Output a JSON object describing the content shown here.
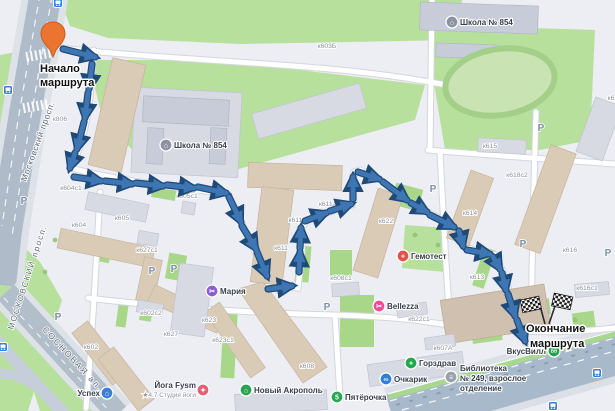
{
  "route": {
    "color": "#3E76B4",
    "outline_color": "#1F4A78",
    "pin_color": "#EA7430",
    "start_label": {
      "line1": "Начало",
      "line2": "маршрута"
    },
    "end_label": {
      "line1": "Окончание",
      "line2": "маршрута"
    },
    "segments": [
      [
        63,
        49,
        95,
        57
      ],
      [
        92,
        64,
        89,
        89
      ],
      [
        88,
        93,
        85,
        118
      ],
      [
        84,
        122,
        77,
        149
      ],
      [
        75,
        153,
        70,
        168
      ],
      [
        74,
        177,
        101,
        181
      ],
      [
        105,
        181,
        132,
        184
      ],
      [
        136,
        183,
        163,
        186
      ],
      [
        167,
        185,
        194,
        188
      ],
      [
        198,
        187,
        226,
        193
      ],
      [
        229,
        197,
        241,
        222
      ],
      [
        242,
        226,
        256,
        249
      ],
      [
        257,
        252,
        267,
        276
      ],
      [
        268,
        289,
        292,
        286
      ],
      [
        299,
        272,
        300,
        252
      ],
      [
        300,
        248,
        301,
        228
      ],
      [
        305,
        221,
        326,
        213
      ],
      [
        330,
        211,
        351,
        204
      ],
      [
        353,
        199,
        353,
        177
      ],
      [
        358,
        172,
        379,
        179
      ],
      [
        383,
        182,
        407,
        200
      ],
      [
        411,
        203,
        427,
        212
      ],
      [
        430,
        215,
        454,
        227
      ],
      [
        459,
        231,
        463,
        246
      ],
      [
        467,
        250,
        490,
        254
      ],
      [
        493,
        257,
        500,
        269
      ],
      [
        502,
        273,
        506,
        290
      ],
      [
        508,
        294,
        515,
        316
      ],
      [
        517,
        320,
        525,
        341
      ]
    ]
  },
  "streets": [
    {
      "name": "Московский просп.",
      "x": 26,
      "y": 182,
      "rotate": -70,
      "size": 8.5,
      "spacing": 0.6
    },
    {
      "name": "МОСКОВСКИЙ просп.",
      "x": 13,
      "y": 330,
      "rotate": -72,
      "size": 8,
      "spacing": 1.6
    },
    {
      "name": "СОСНОВАЯ ал.",
      "x": 42,
      "y": 330,
      "rotate": 47,
      "size": 8.5,
      "spacing": 1.8
    }
  ],
  "buildings": [
    {
      "label": "к806",
      "x": 60,
      "y": 121
    },
    {
      "label": "к604с1",
      "x": 71,
      "y": 190
    },
    {
      "label": "к605с1",
      "x": 187,
      "y": 198
    },
    {
      "label": "к605",
      "x": 122,
      "y": 220
    },
    {
      "label": "к604",
      "x": 79,
      "y": 227
    },
    {
      "label": "к627с1",
      "x": 147,
      "y": 252
    },
    {
      "label": "к602с2",
      "x": 151,
      "y": 315
    },
    {
      "label": "к627",
      "x": 171,
      "y": 336
    },
    {
      "label": "к602",
      "x": 91,
      "y": 349
    },
    {
      "label": "к623",
      "x": 209,
      "y": 322
    },
    {
      "label": "к623с1",
      "x": 223,
      "y": 342
    },
    {
      "label": "к603Б",
      "x": 327,
      "y": 48
    },
    {
      "label": "к611А",
      "x": 328,
      "y": 206
    },
    {
      "label": "к611с1",
      "x": 299,
      "y": 222
    },
    {
      "label": "к611",
      "x": 281,
      "y": 250
    },
    {
      "label": "к622",
      "x": 386,
      "y": 223
    },
    {
      "label": "к608с1",
      "x": 341,
      "y": 280
    },
    {
      "label": "к608",
      "x": 307,
      "y": 368
    },
    {
      "label": "к615",
      "x": 490,
      "y": 148
    },
    {
      "label": "к618с2",
      "x": 517,
      "y": 177
    },
    {
      "label": "к614",
      "x": 470,
      "y": 215
    },
    {
      "label": "к616",
      "x": 570,
      "y": 252
    },
    {
      "label": "к613",
      "x": 477,
      "y": 279
    },
    {
      "label": "к616с1",
      "x": 587,
      "y": 290
    },
    {
      "label": "к622с1",
      "x": 419,
      "y": 321
    },
    {
      "label": "к607А",
      "x": 443,
      "y": 350
    },
    {
      "label": "к6",
      "x": 611,
      "y": 100
    }
  ],
  "pois": [
    {
      "id": "school-854-west",
      "icon": {
        "x": 166,
        "y": 145,
        "color": "#8A92A3",
        "glyph": "⌂"
      },
      "lines": [
        {
          "t": "Школа № 854",
          "x": 174,
          "y": 148,
          "anchor": "start"
        }
      ]
    },
    {
      "id": "school-854-east",
      "icon": {
        "x": 452,
        "y": 22,
        "color": "#8A92A3",
        "glyph": "⌂"
      },
      "lines": [
        {
          "t": "Школа № 854",
          "x": 460,
          "y": 25,
          "anchor": "start"
        }
      ]
    },
    {
      "id": "maria",
      "icon": {
        "x": 212,
        "y": 291,
        "color": "#8A5FD0",
        "glyph": "✂"
      },
      "lines": [
        {
          "t": "Мария",
          "x": 220,
          "y": 294,
          "anchor": "start"
        }
      ]
    },
    {
      "id": "gemotest",
      "icon": {
        "x": 403,
        "y": 256,
        "color": "#E0524B",
        "glyph": "+"
      },
      "lines": [
        {
          "t": "Гемотест",
          "x": 411,
          "y": 259,
          "anchor": "start",
          "color": "#E0524B"
        }
      ]
    },
    {
      "id": "bellezza",
      "icon": {
        "x": 379,
        "y": 306,
        "color": "#ED4C9B",
        "glyph": "✂"
      },
      "lines": [
        {
          "t": "Bellezza",
          "x": 387,
          "y": 309,
          "anchor": "start",
          "color": "#E2519B"
        }
      ]
    },
    {
      "id": "novy-akropol",
      "icon": {
        "x": 246,
        "y": 390,
        "color": "#27A550",
        "glyph": "⌂"
      },
      "lines": [
        {
          "t": "Новый Акрополь",
          "x": 254,
          "y": 393,
          "anchor": "start"
        }
      ]
    },
    {
      "id": "pyaterochka",
      "icon": {
        "x": 337,
        "y": 397,
        "color": "#28A653",
        "glyph": "5"
      },
      "lines": [
        {
          "t": "Пятёрочка",
          "x": 345,
          "y": 400,
          "anchor": "start"
        }
      ]
    },
    {
      "id": "gorzdrav",
      "icon": {
        "x": 411,
        "y": 363,
        "color": "#23A84F",
        "glyph": "+"
      },
      "lines": [
        {
          "t": "Горздрав",
          "x": 419,
          "y": 366,
          "anchor": "start"
        }
      ]
    },
    {
      "id": "ochkarik",
      "icon": {
        "x": 386,
        "y": 379,
        "color": "#2F7FD6",
        "glyph": "∞"
      },
      "lines": [
        {
          "t": "Очкарик",
          "x": 394,
          "y": 382,
          "anchor": "start"
        }
      ]
    },
    {
      "id": "vkusvill",
      "icon": {
        "x": 554,
        "y": 351,
        "color": "#22A24C",
        "glyph": "ВВ",
        "gsize": 4.5
      },
      "lines": [
        {
          "t": "ВкусВилл",
          "x": 546,
          "y": 354,
          "anchor": "end"
        }
      ]
    },
    {
      "id": "library-249",
      "icon": {
        "x": 451,
        "y": 377,
        "color": "#99A1AD",
        "glyph": "≡"
      },
      "lines": [
        {
          "t": "Библиотека",
          "x": 460,
          "y": 371,
          "anchor": "start",
          "color": "#4A5360"
        },
        {
          "t": "№ 249, взрослое",
          "x": 460,
          "y": 381,
          "anchor": "start",
          "color": "#4A5360"
        },
        {
          "t": "отделение",
          "x": 460,
          "y": 391,
          "anchor": "start",
          "color": "#4A5360"
        }
      ]
    },
    {
      "id": "uspekh",
      "icon": {
        "x": 107,
        "y": 393,
        "color": "#3D7EDB",
        "glyph": "⌂"
      },
      "lines": [
        {
          "t": "Успех",
          "x": 100,
          "y": 396,
          "anchor": "end"
        }
      ]
    },
    {
      "id": "yoga-fysm",
      "icon": {
        "x": 203,
        "y": 390,
        "color": "#E85D75",
        "glyph": "✦"
      },
      "lines": [
        {
          "t": "Йога Fysm",
          "x": 196,
          "y": 388,
          "anchor": "end"
        },
        {
          "t": "★4.7 Студия йоги",
          "x": 196,
          "y": 397,
          "anchor": "end",
          "sub": true
        }
      ]
    }
  ],
  "parking": {
    "glyph": "P",
    "positions": [
      [
        24,
        200
      ],
      [
        152,
        270
      ],
      [
        174,
        268
      ],
      [
        58,
        316
      ],
      [
        327,
        306
      ],
      [
        433,
        188
      ],
      [
        523,
        243
      ],
      [
        541,
        127
      ],
      [
        608,
        252
      ]
    ]
  },
  "transit_stops": [
    [
      58,
      3
    ],
    [
      8,
      90
    ],
    [
      597,
      373
    ],
    [
      553,
      406
    ],
    [
      3,
      347
    ]
  ]
}
